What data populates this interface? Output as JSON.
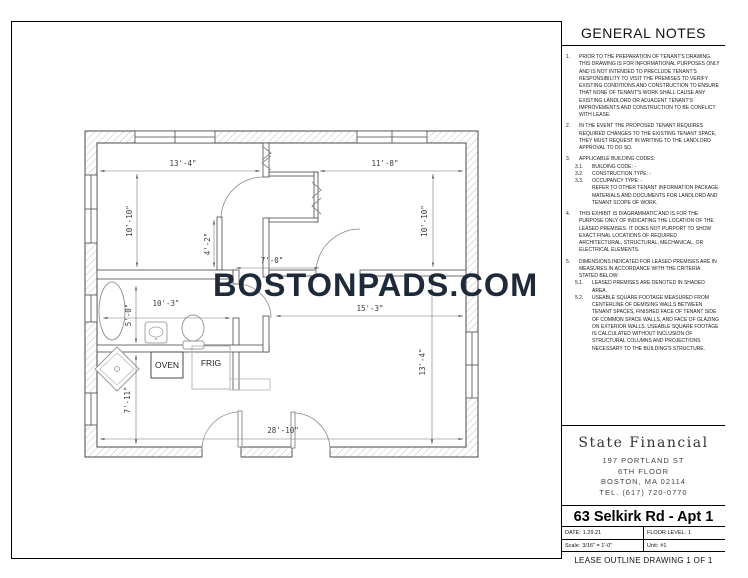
{
  "watermark": "BOSTONPADS.COM",
  "general_notes": {
    "title": "GENERAL NOTES",
    "items": [
      {
        "num": "1.",
        "indent": 0,
        "text": "PRIOR TO THE PREPARATION OF TENANT'S DRAWING.  THIS DRAWING IS FOR INFORMATIONAL PURPOSES ONLY AND IS NOT INTENDED TO PRECLUDE TENANT'S RESPONSIBILITY TO VISIT THE PREMISES TO VERIFY EXISTING CONDITIONS AND CONSTRUCTION TO ENSURE THAT NONE OF TENANT'S WORK SHALL CAUSE ANY EXISTING LANDLORD OR ADJACENT TENANT'S IMPROVEMENTS AND CONSTRUCTION TO BE CONFLICT WITH LEASE."
      },
      {
        "num": "2.",
        "indent": 0,
        "text": "IN THE EVENT THE PROPOSED TENANT REQUIRES REQUIRED CHANGES TO THE EXISTING TENANT SPACE, THEY MUST REQUEST  IN WRITING TO THE LANDLORD APPROVAL TO DO SO."
      },
      {
        "num": "3.",
        "indent": 0,
        "text": "APPLICABLE BUILDING CODES:"
      },
      {
        "num": "3.1.",
        "indent": 1,
        "text": "BUILDING CODE:    -"
      },
      {
        "num": "3.2.",
        "indent": 1,
        "text": "CONSTRUCTION TYPE:    -"
      },
      {
        "num": "3.3.",
        "indent": 1,
        "text": "OCCUPANCY TYPE:    -"
      },
      {
        "num": "",
        "indent": 1,
        "text": "REFER TO OTHER TENANT INFORMATION PACKAGE MATERIALS AND DOCUMENTS FOR LANDLORD AND TENANT SCOPE OF WORK."
      },
      {
        "num": "4.",
        "indent": 0,
        "text": "THIS EXHIBIT IS DIAGRAMMATIC AND IS FOR THE PURPOSE ONLY OF INDICATING THE LOCATION OF THE LEASED PREMISES.  IT DOES NOT PURPORT TO SHOW EXACT FINAL LOCATIONS OF REQUIRED ARCHITECTURAL, STRUCTURAL, MECHANICAL, OR ELECTRICAL ELEMENTS."
      },
      {
        "num": "5.",
        "indent": 0,
        "text": "DIMENSIONS INDICATED FOR LEASED PREMISES ARE IN MEASURES IN ACCORDANCE WITH THE CRITERIA STATED BELOW:"
      },
      {
        "num": "5.1.",
        "indent": 1,
        "text": "LEASED PREMISES ARE DENOTED IN SHADED AREA."
      },
      {
        "num": "5.2.",
        "indent": 1,
        "text": "USEABLE SQUARE FOOTAGE MEASURED FROM CENTERLINE OF DEMISING WALLS BETWEEN TENANT SPACES, FINISHED FACE OF TENANT SIDE OF COMMON SPACE WALLS, AND FACE OF GLAZING ON EXTERIOR WALLS.  USEABLE SQUARE FOOTAGE IS CALCULATED WITHOUT INCLUSION OF STRUCTURAL COLUMNS AND PROJECTIONS NECESSARY TO THE BUILDING'S STRUCTURE."
      }
    ]
  },
  "title_block": {
    "company": "State Financial",
    "address_line1": "197 PORTLAND ST",
    "address_line2": "6TH FLOOR",
    "address_line3": "BOSTON, MA 02114",
    "phone": "TEL. (617) 720-0770",
    "project": "63 Selkirk Rd - Apt 1",
    "date_label": "DATE:",
    "date": "1.29.21",
    "floor_label": "FLOOR LEVEL:",
    "floor": "1",
    "scale_label": "Scale:",
    "scale": "3/16\" = 1'-0\"",
    "unit_label": "Unit:",
    "unit": "#1",
    "sheet_title": "LEASE OUTLINE DRAWING 1 OF 1"
  },
  "plan": {
    "labels": {
      "oven": "OVEN",
      "frig": "FRIG"
    },
    "dimensions": [
      {
        "text": "13'-4\"",
        "location": "bedroom-1-width"
      },
      {
        "text": "11'-8\"",
        "location": "bedroom-2-width"
      },
      {
        "text": "10'-10\"",
        "location": "bedroom-1-depth"
      },
      {
        "text": "10'-10\"",
        "location": "bedroom-2-depth"
      },
      {
        "text": "4'-2\"",
        "location": "bedroom-1-wall-segment"
      },
      {
        "text": "7'-0\"",
        "location": "hall-width"
      },
      {
        "text": "5'-0\"",
        "location": "bathroom-depth"
      },
      {
        "text": "10'-3\"",
        "location": "bathroom-width"
      },
      {
        "text": "15'-3\"",
        "location": "living-room-width"
      },
      {
        "text": "7'-11\"",
        "location": "kitchen-depth"
      },
      {
        "text": "13'-4\"",
        "location": "living-room-depth"
      },
      {
        "text": "28'-10\"",
        "location": "overall-width"
      }
    ],
    "colors": {
      "watermark": "#1e2a38",
      "wall_line": "#4a4a4a",
      "hatch": "#c2c2c2"
    }
  }
}
